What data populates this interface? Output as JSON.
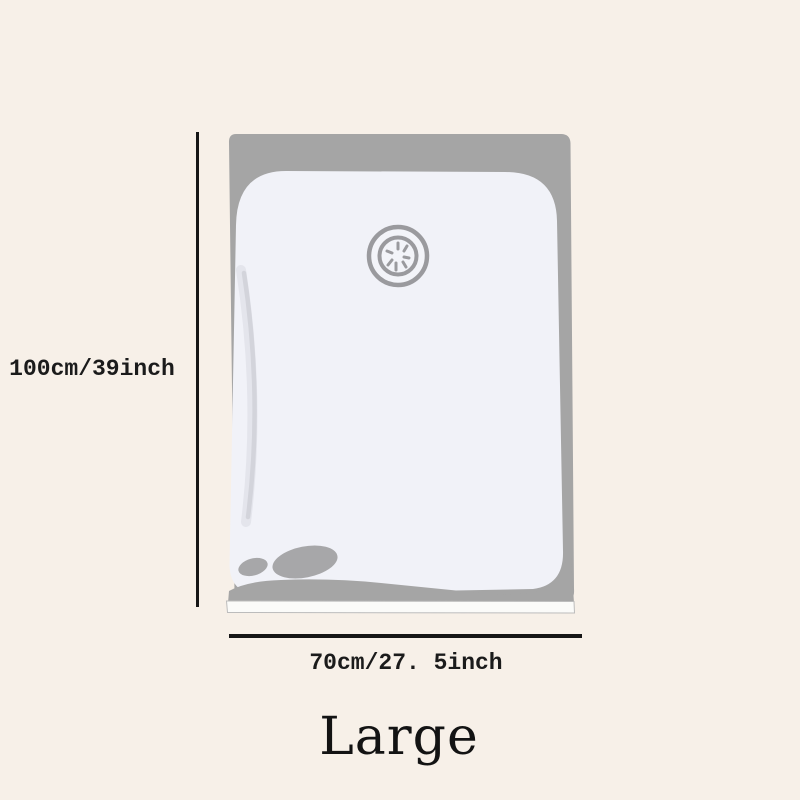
{
  "page": {
    "background_color": "#f7f0e8",
    "text_color": "#1b1b1b",
    "dimension_line_color": "#161616"
  },
  "product": {
    "size_label": "Large",
    "height_label": "100cm/39inch",
    "width_label": "70cm/27. 5inch"
  },
  "illustration": {
    "type": "vacuum-storage-bag",
    "icons": {
      "valve": "suction-valve-icon"
    },
    "colors": {
      "bag_fill": "#f1f2f8",
      "bag_shadow_gray": "#a5a5a5",
      "valve_stroke": "#9a9a9e",
      "crease": "#d3d4db",
      "seal_fill": "#fbfbf9"
    }
  }
}
